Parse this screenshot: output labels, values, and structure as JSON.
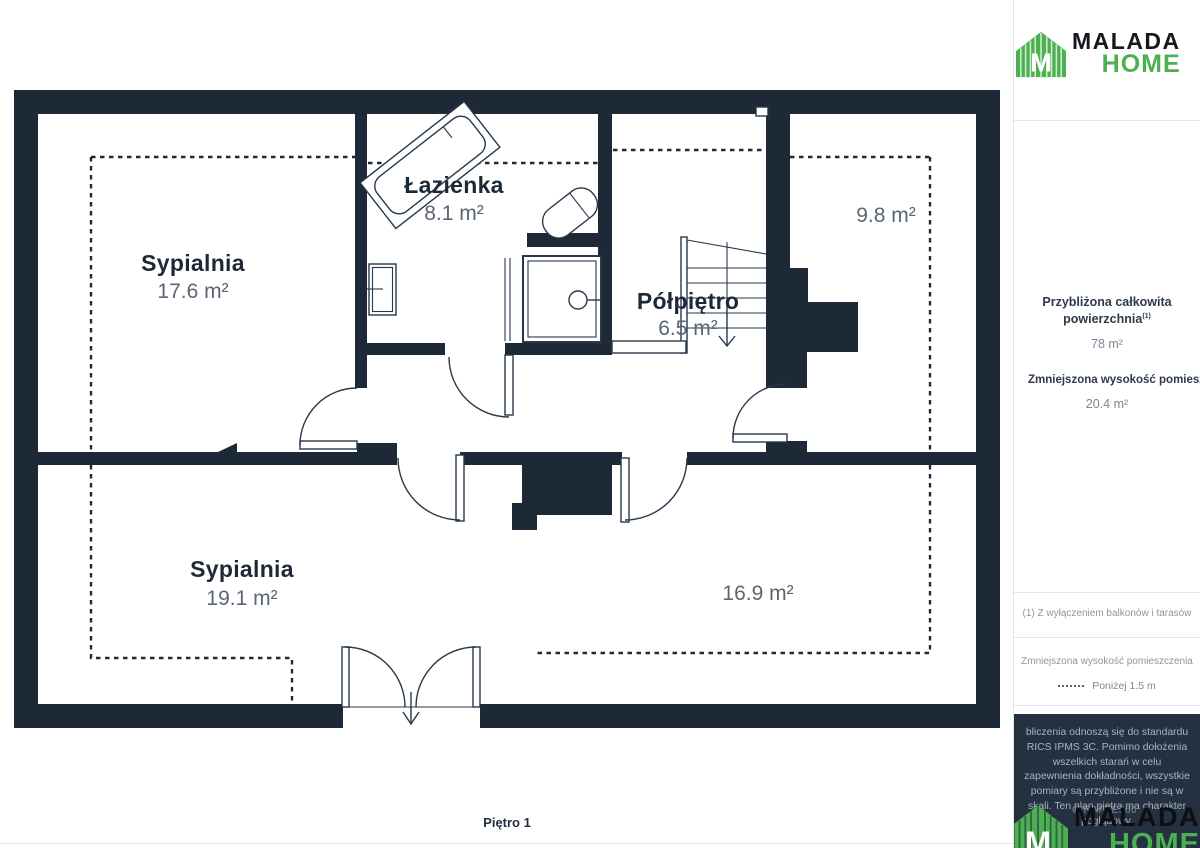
{
  "brand": {
    "primary": "MALADA",
    "secondary": "HOME"
  },
  "floorplan": {
    "floor_label": "Piętro 1",
    "rooms": [
      {
        "id": "sypialnia-gorna",
        "name": "Sypialnia",
        "area": "17.6 m²"
      },
      {
        "id": "lazienka",
        "name": "Łazienka",
        "area": "8.1 m²"
      },
      {
        "id": "polpietro",
        "name": "Półpiętro",
        "area": "6.5 m²"
      },
      {
        "id": "pokoj-9-8",
        "name": "",
        "area": "9.8 m²"
      },
      {
        "id": "sypialnia-dolna",
        "name": "Sypialnia",
        "area": "19.1 m²"
      },
      {
        "id": "pokoj-16-9",
        "name": "",
        "area": "16.9 m²"
      }
    ]
  },
  "sidebar": {
    "summary": {
      "total_label": "Przybliżona całkowita powierzchnia",
      "total_footnote_marker": "(1)",
      "total_value": "78 m²",
      "reduced_label": "Zmniejszona wysokość pomieszczenia",
      "reduced_value": "20.4 m²"
    },
    "footnote": "(1) Z wyłączeniem balkonów i tarasów",
    "legend": {
      "title": "Zmniejszona wysokość pomieszczenia",
      "item_label": "Poniżej 1.5 m"
    },
    "disclaimer": "bliczenia odnoszą się do standardu RICS IPMS 3C. Pomimo dołożenia wszelkich starań w celu zapewnienia dokładności, wszystkie pomiary są przybliżone i nie są w skali. Ten plan piętra ma charakter poglądowy.",
    "watermark": "GIRAFFE360"
  },
  "colors": {
    "wall": "#1e2937",
    "accent_green": "#4caf50",
    "area_text": "#5b6673"
  }
}
